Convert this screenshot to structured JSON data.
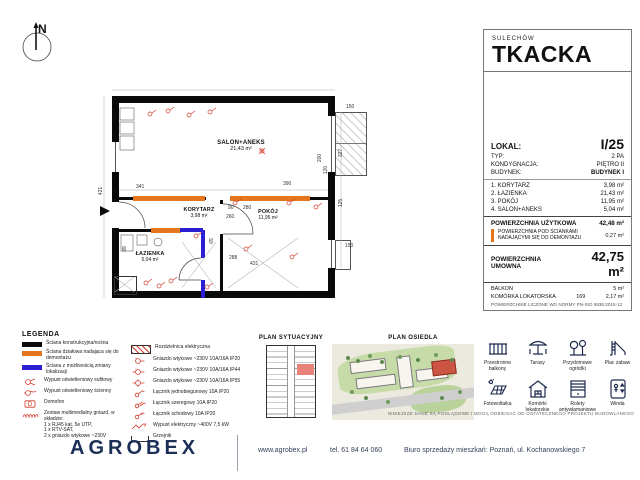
{
  "compass": {
    "label": "N"
  },
  "title_block": {
    "city": "SULECHÓW",
    "name": "TKACKA",
    "lokal_label": "LOKAL:",
    "lokal_value": "I/25",
    "info": [
      {
        "label": "TYP:",
        "value": "2 PA"
      },
      {
        "label": "KONDYGNACJA:",
        "value": "PIĘTRO II"
      },
      {
        "label": "BUDYNEK:",
        "value": "BUDYNEK I"
      }
    ],
    "rooms": [
      {
        "label": "1. KORYTARZ",
        "area": "3,98 m²"
      },
      {
        "label": "2. ŁAZIENKA",
        "area": "21,43 m²"
      },
      {
        "label": "3. POKÓJ",
        "area": "11,95 m²"
      },
      {
        "label": "4. SALON+ANEKS",
        "area": "5,04 m²"
      }
    ],
    "uzytkowa_label": "POWIERZCHNIA UŻYTKOWA",
    "uzytkowa_value": "42,48 m²",
    "demontaz_label": "POWIERZCHNIA POD ŚCIANKAMI NADAJĄCYMI SIĘ DO DEMONTAŻU",
    "demontaz_value": "0,27 m²",
    "umowna_label": "POWIERZCHNIA UMOWNA",
    "umowna_value": "42,75 m²",
    "balkon_label": "BALKON",
    "balkon_value": "5 m²",
    "komorka_label": "KOMÓRKA LOKATORSKA",
    "komorka_number": "169",
    "komorka_value": "2,17 m²",
    "note": "POWIERZCHNIE LICZONE WG NORMY PN-ISO 9836:2015-12"
  },
  "plan": {
    "rooms": {
      "salon": {
        "name": "SALON+ANEKS",
        "area": "21,43 m²"
      },
      "korytarz": {
        "name": "KORYTARZ",
        "area": "3,98 m²"
      },
      "pokoj": {
        "name": "POKÓJ",
        "area": "11,95 m²"
      },
      "lazienka": {
        "name": "ŁAZIENKA",
        "area": "5,04 m²"
      }
    },
    "dimensions": [
      "341",
      "390",
      "90",
      "260",
      "280",
      "421",
      "327",
      "200",
      "120",
      "150",
      "125",
      "99",
      "431",
      "288",
      "65",
      "150"
    ]
  },
  "legend": {
    "title": "LEGENDA",
    "walls": [
      {
        "label": "Ściana konstrukcyjna/nośna"
      },
      {
        "label": "Ściana działowa nadająca się do demontażu"
      },
      {
        "label": "Ściana z możliwością zmiany lokalizacji"
      },
      {
        "label": "Wypust oświetleniowy sufitowy"
      },
      {
        "label": "Wypust oświetleniowy ścienny"
      },
      {
        "label": "Domofon",
        "icon_text": "D"
      },
      {
        "label": "Zestaw multimedialny gniazd, w składzie:\n1 x RJ45 kat. 5e UTP,\n1 x RTV-SAT,\n2 x gniazdo wtykowe ~230V"
      }
    ],
    "electrical": [
      {
        "label": "Rozdzielnica elektryczna"
      },
      {
        "label": "Gniazdo wtykowe ~230V 10A/16A IP20"
      },
      {
        "label": "Gniazdo wtykowe ~230V 10A/16A IP44"
      },
      {
        "label": "Gniazdo wtykowe ~230V 10A/16A IP55"
      },
      {
        "label": "Łącznik jednobiegunowy 10A IP20"
      },
      {
        "label": "Łącznik szeregowy 10A IP20"
      },
      {
        "label": "Łącznik schodowy 10A IP20"
      },
      {
        "label": "Wypust elektryczny ~400V 7,5 kW"
      },
      {
        "label": "Grzejnik"
      }
    ]
  },
  "mini_plans": {
    "sytuacyjny_title": "PLAN SYTUACYJNY",
    "osiedla_title": "PLAN OSIEDLA"
  },
  "features": {
    "items": [
      {
        "label": "Przestronne balkony"
      },
      {
        "label": "Tarasy"
      },
      {
        "label": "Przydomowe ogródki"
      },
      {
        "label": "Plac zabaw"
      },
      {
        "label": "Fotowoltaika"
      },
      {
        "label": "Komórki lokatorskie"
      },
      {
        "label": "Rolety antywłamaniowe"
      },
      {
        "label": "Winda"
      }
    ]
  },
  "disclaimer": "NINIEJSZE DANE SĄ POGLĄDOWE I MOGĄ ODBIEGAĆ OD OSTATECZNEGO PROJEKTU BUDOWLANEGO",
  "footer": {
    "logo": "AGROBEX",
    "website": "www.agrobex.pl",
    "phone": "tel. 61 84 64 060",
    "office": "Biuro sprzedaży mieszkań: Poznań, ul. Kochanowskiego 7"
  },
  "colors": {
    "wall_black": "#0a0a0a",
    "wall_demolition_orange": "#e5761e",
    "wall_movable_blue": "#2b1fd4",
    "electrical_red": "#d23a2a",
    "unit_highlight": "#e8837a",
    "brand_navy": "#1c2f56"
  }
}
